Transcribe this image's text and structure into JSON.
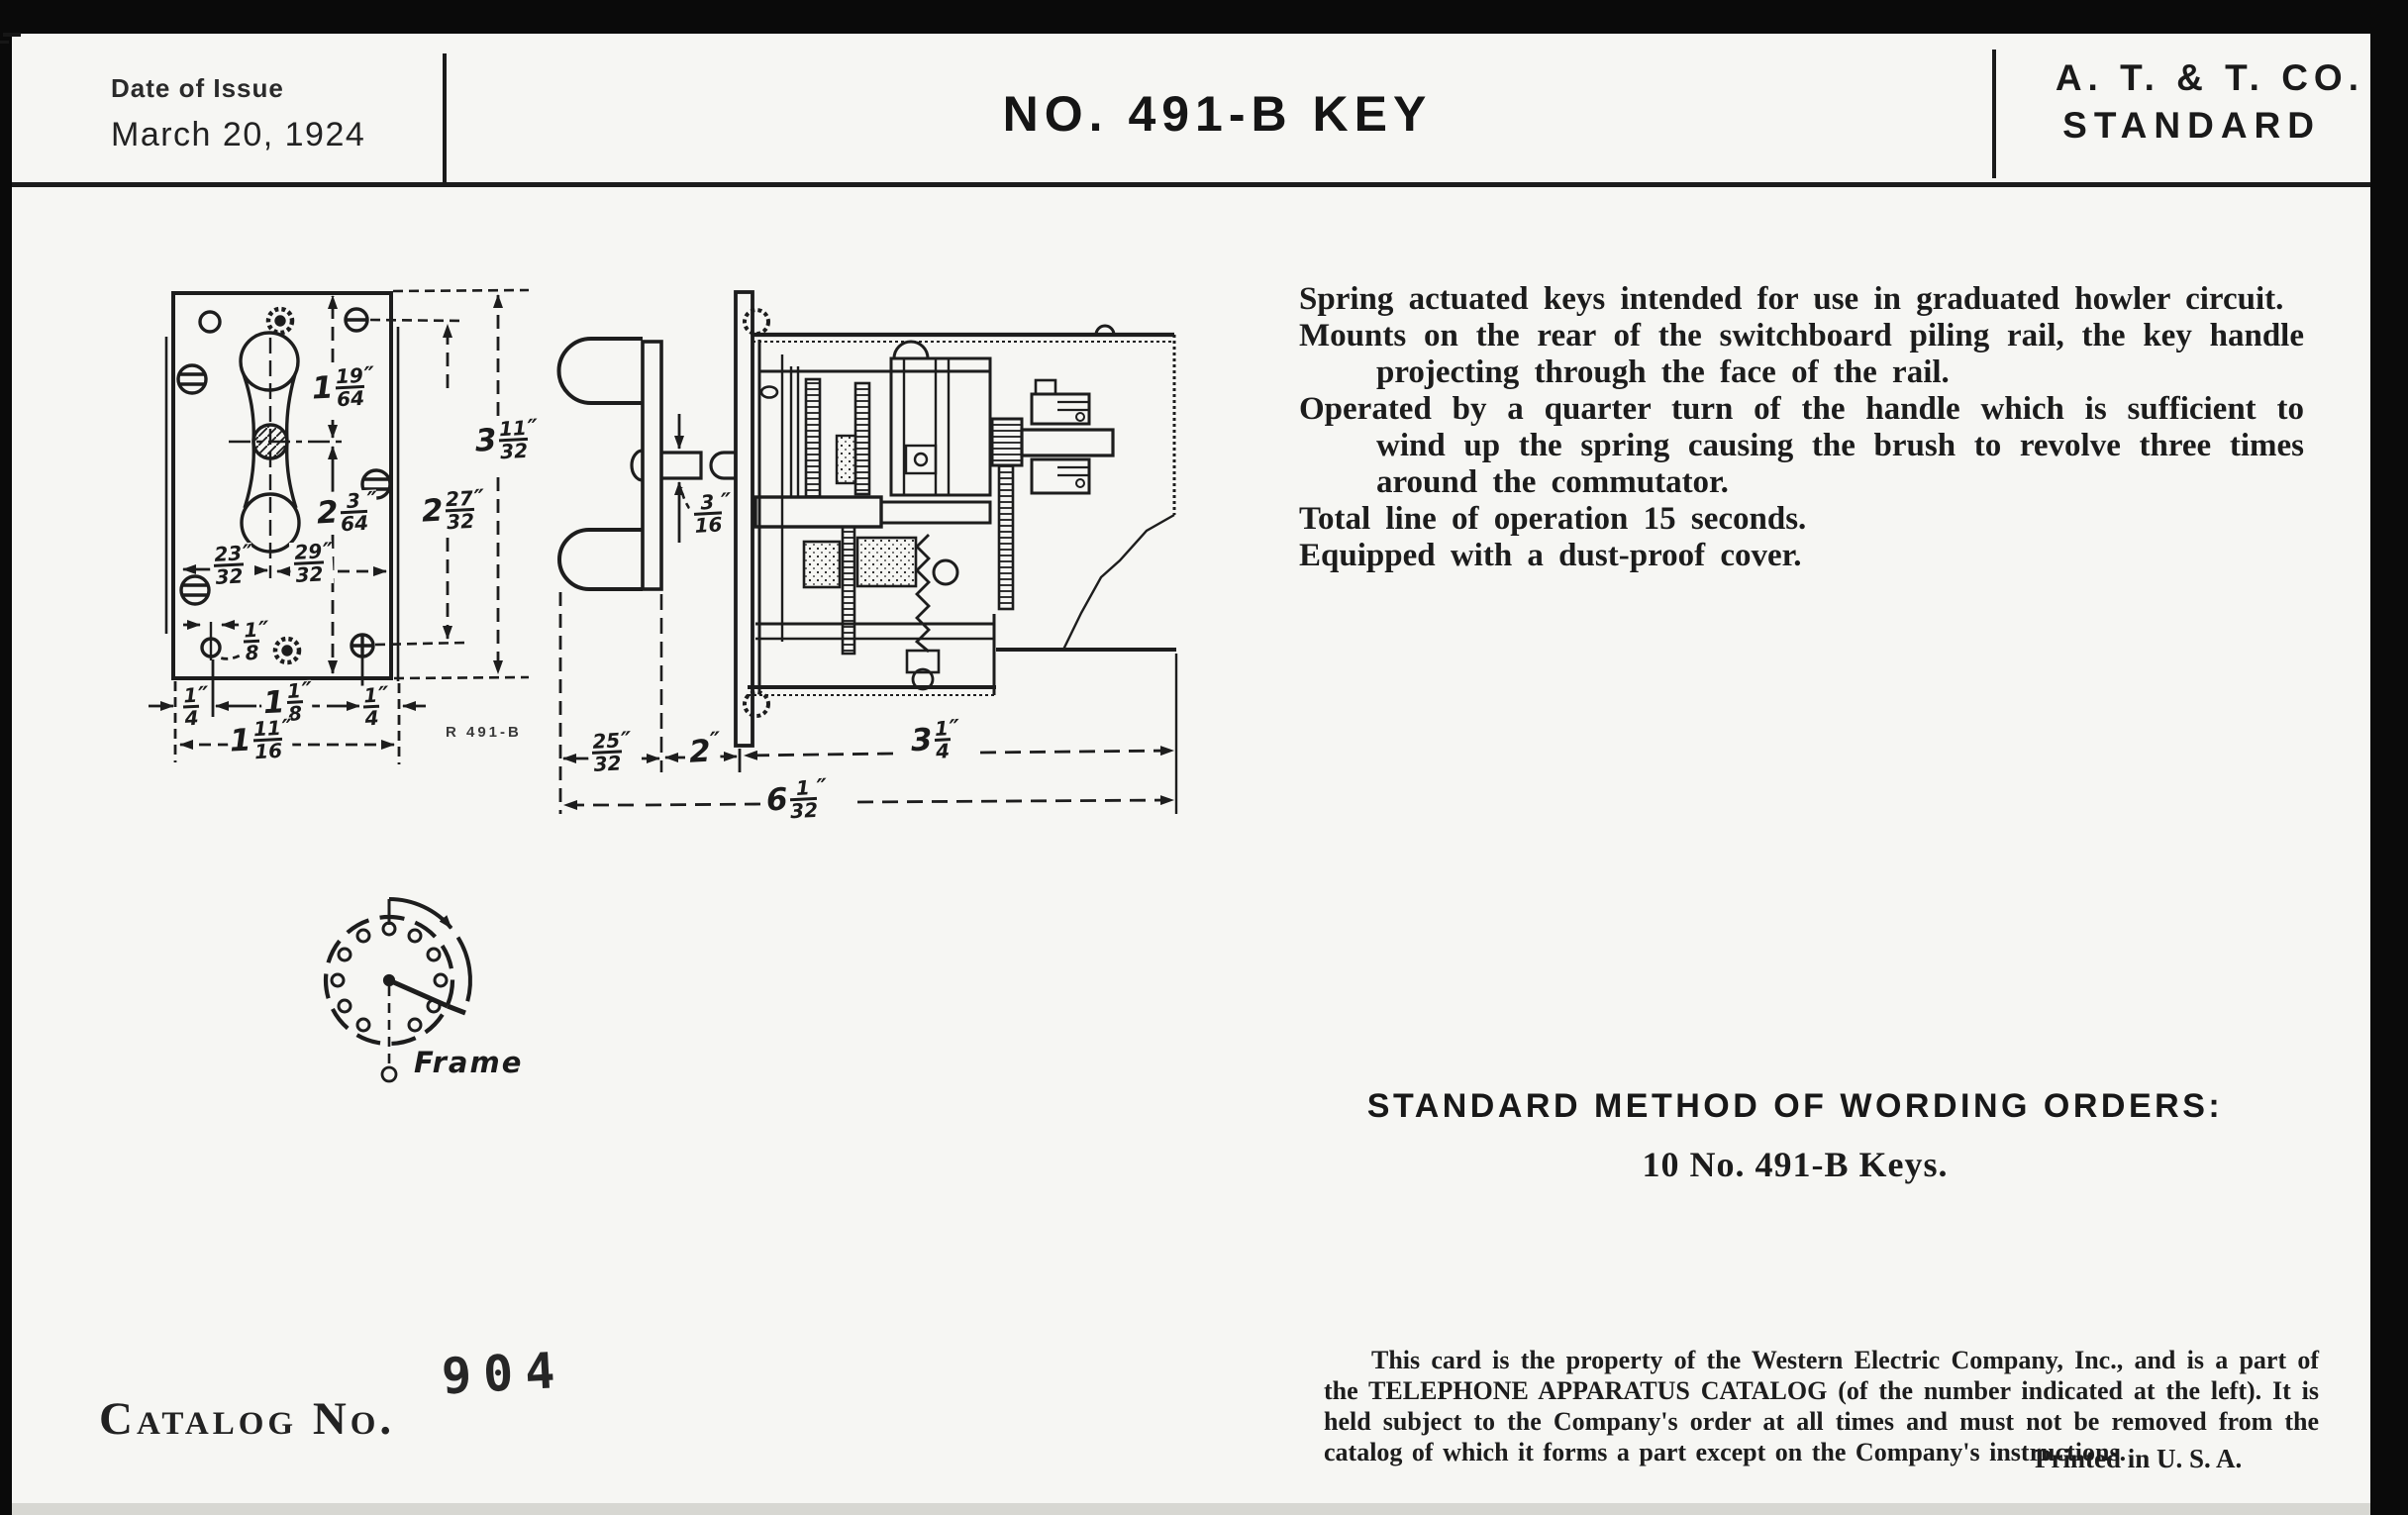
{
  "header": {
    "date_label": "Date of Issue",
    "date_value": "March 20, 1924",
    "title": "NO. 491-B KEY",
    "org_line1": "A. T. & T. CO.",
    "org_line2": "STANDARD"
  },
  "description": {
    "items": [
      "Spring actuated keys intended for use in graduated howler circuit.",
      "Mounts on the rear of the switchboard piling rail, the key handle projecting through the face of the rail.",
      "Operated by a quarter turn of the handle which is sufficient to wind up the spring causing the brush to revolve three times around the commutator.",
      "Total line of operation 15 seconds.",
      "Equipped with a dust-proof cover."
    ]
  },
  "ordering": {
    "heading": "STANDARD METHOD OF WORDING ORDERS:",
    "example": "10 No. 491-B Keys."
  },
  "catalog": {
    "label": "Catalog No.",
    "number": "904"
  },
  "notice": {
    "body": "This card is the property of the Western Electric Company, Inc., and is a part of the TELEPHONE APPARATUS CATALOG (of the number indicated at the left).  It is held subject to the Company's order at all times and must not be removed from the catalog of which it forms a part except on the Company's instructions.",
    "printed": "Printed in U. S. A."
  },
  "drawing": {
    "stamp": "R 491-B",
    "frame_label": "Frame",
    "front_dims": [
      {
        "w": "1",
        "n": "19",
        "d": "64",
        "u": "″"
      },
      {
        "w": "2",
        "n": "3",
        "d": "64",
        "u": "″"
      },
      {
        "w": "",
        "n": "23",
        "d": "32",
        "u": "″"
      },
      {
        "w": "",
        "n": "29",
        "d": "32",
        "u": "″"
      },
      {
        "w": "2",
        "n": "27",
        "d": "32",
        "u": "″"
      },
      {
        "w": "3",
        "n": "11",
        "d": "32",
        "u": "″"
      },
      {
        "w": "",
        "n": "1",
        "d": "8",
        "u": "″"
      },
      {
        "w": "",
        "n": "1",
        "d": "4",
        "u": "″"
      },
      {
        "w": "1",
        "n": "1",
        "d": "8",
        "u": "″"
      },
      {
        "w": "",
        "n": "1",
        "d": "4",
        "u": "″"
      },
      {
        "w": "1",
        "n": "11",
        "d": "16",
        "u": "″"
      }
    ],
    "side_dims": [
      {
        "w": "",
        "n": "3",
        "d": "16",
        "u": "″"
      },
      {
        "w": "",
        "n": "25",
        "d": "32",
        "u": "″"
      },
      {
        "w": "2",
        "n": "",
        "d": "",
        "u": "″"
      },
      {
        "w": "3",
        "n": "1",
        "d": "4",
        "u": "″"
      },
      {
        "w": "6",
        "n": "1",
        "d": "32",
        "u": "″"
      }
    ]
  }
}
